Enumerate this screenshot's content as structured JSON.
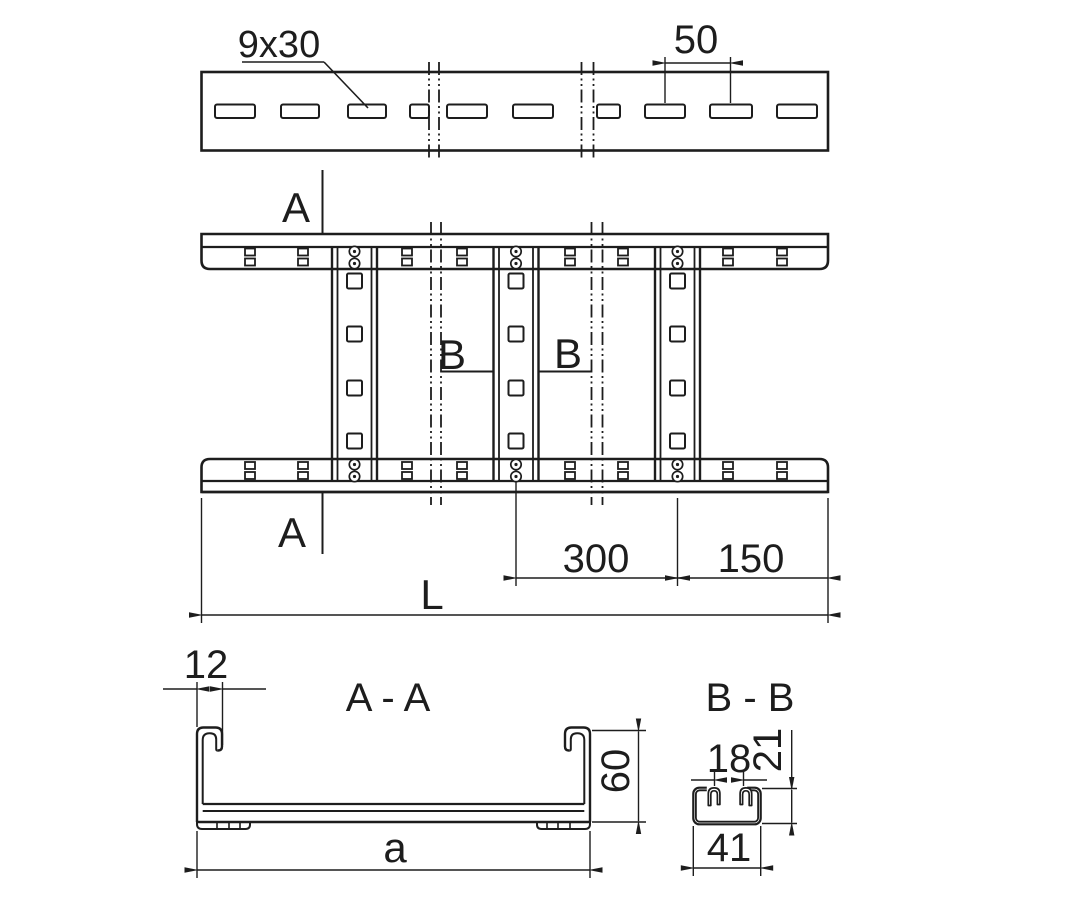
{
  "drawing": {
    "colors": {
      "line": "#1d1d1d",
      "background": "#ffffff"
    },
    "top_view": {
      "slot_label": "9x30",
      "slot_pitch": "50"
    },
    "plan_view": {
      "section_a_top": "A",
      "section_a_bottom": "A",
      "section_b_left": "B",
      "section_b_right": "B",
      "dim_rung_spacing": "300",
      "dim_end_spacing": "150",
      "dim_length": "L"
    },
    "section_aa": {
      "title": "A - A",
      "dim_lip": "12",
      "dim_height": "60",
      "dim_width": "a"
    },
    "section_bb": {
      "title": "B - B",
      "dim_opening": "18",
      "dim_height": "21",
      "dim_width": "41"
    }
  }
}
